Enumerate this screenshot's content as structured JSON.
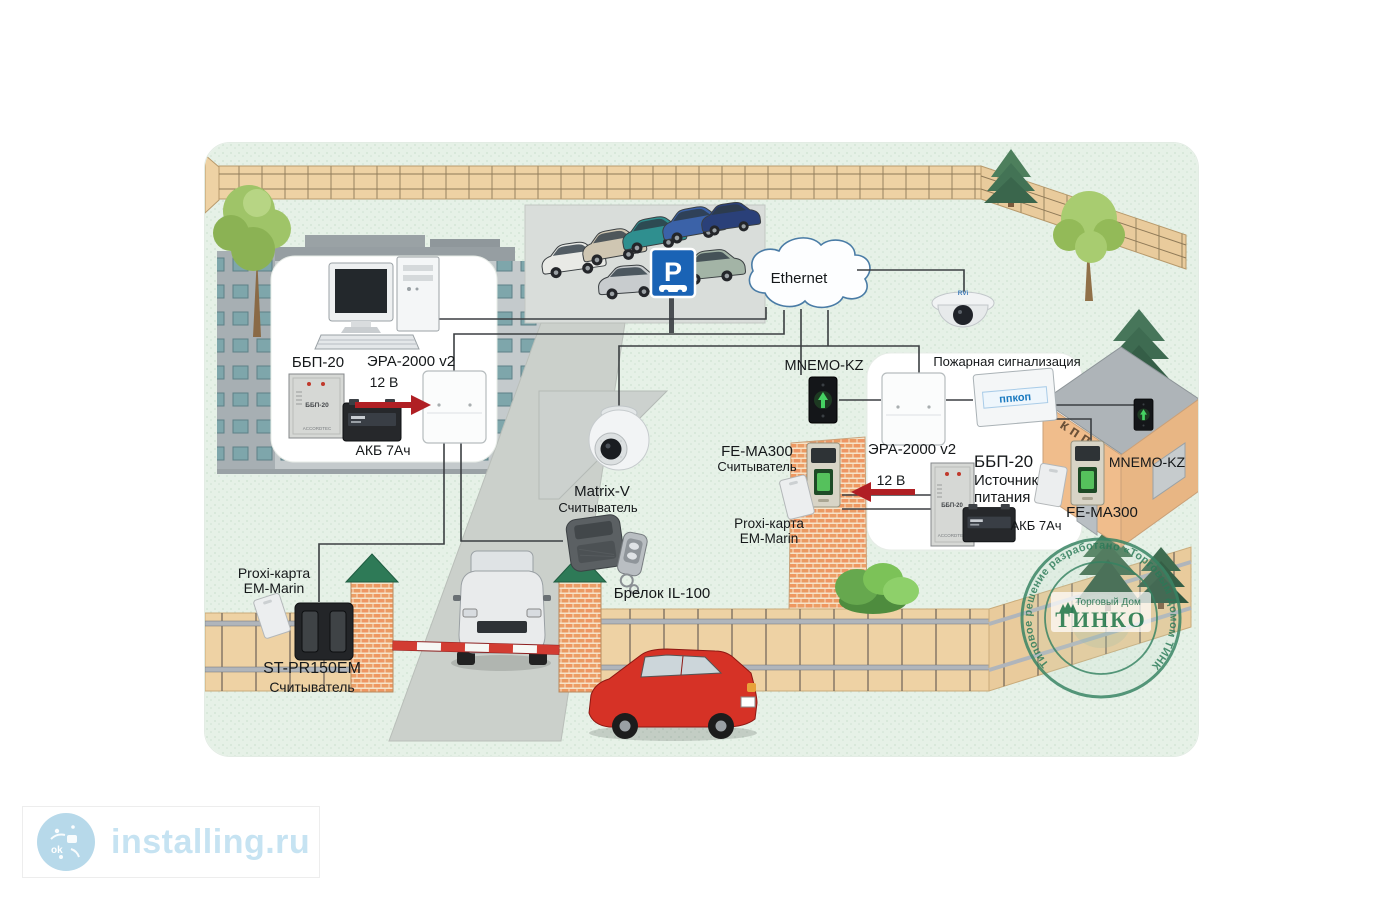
{
  "labels": {
    "bbp20": "ББП-20",
    "era2000": "ЭРА-2000 v2",
    "v12": "12 В",
    "akb7": "АКБ 7Ач",
    "ethernet": "Ethernet",
    "mnemo_kz": "MNEMO-KZ",
    "fire_alarm": "Пожарная сигнализация",
    "psu_line1": "Источник",
    "psu_line2": "питания",
    "fe_ma300": "FE-MA300",
    "reader": "Считыватель",
    "proxi_card": "Proxi-карта",
    "em_marin": "EM-Marin",
    "matrix_v": "Matrix-V",
    "keyfob_il100": "Брелок IL-100",
    "st_pr150em": "ST-PR150EM"
  },
  "devices": {
    "ppkop": "ппкоп",
    "kpp": "кпп",
    "parking": "P",
    "rvi": "RVi",
    "bbp_face": "ББП-20",
    "bbp_brand": "ACCORDTEC"
  },
  "stamp": {
    "ring": "Типовое решение разработано «Торговым Домом ТИНКО»",
    "house": "Торговый Дом",
    "brand": "ТИНКО"
  },
  "watermark": {
    "site": "installing.ru",
    "icon_text": "ok"
  },
  "colors": {
    "arrow_red": "#b01f24",
    "stamp_green": "#2e7d5b",
    "sign_blue": "#1a63b5",
    "fence_tan": "#eed2a4",
    "grass": "#e6f1e7",
    "watermark_blue": "#c6e3f2"
  }
}
